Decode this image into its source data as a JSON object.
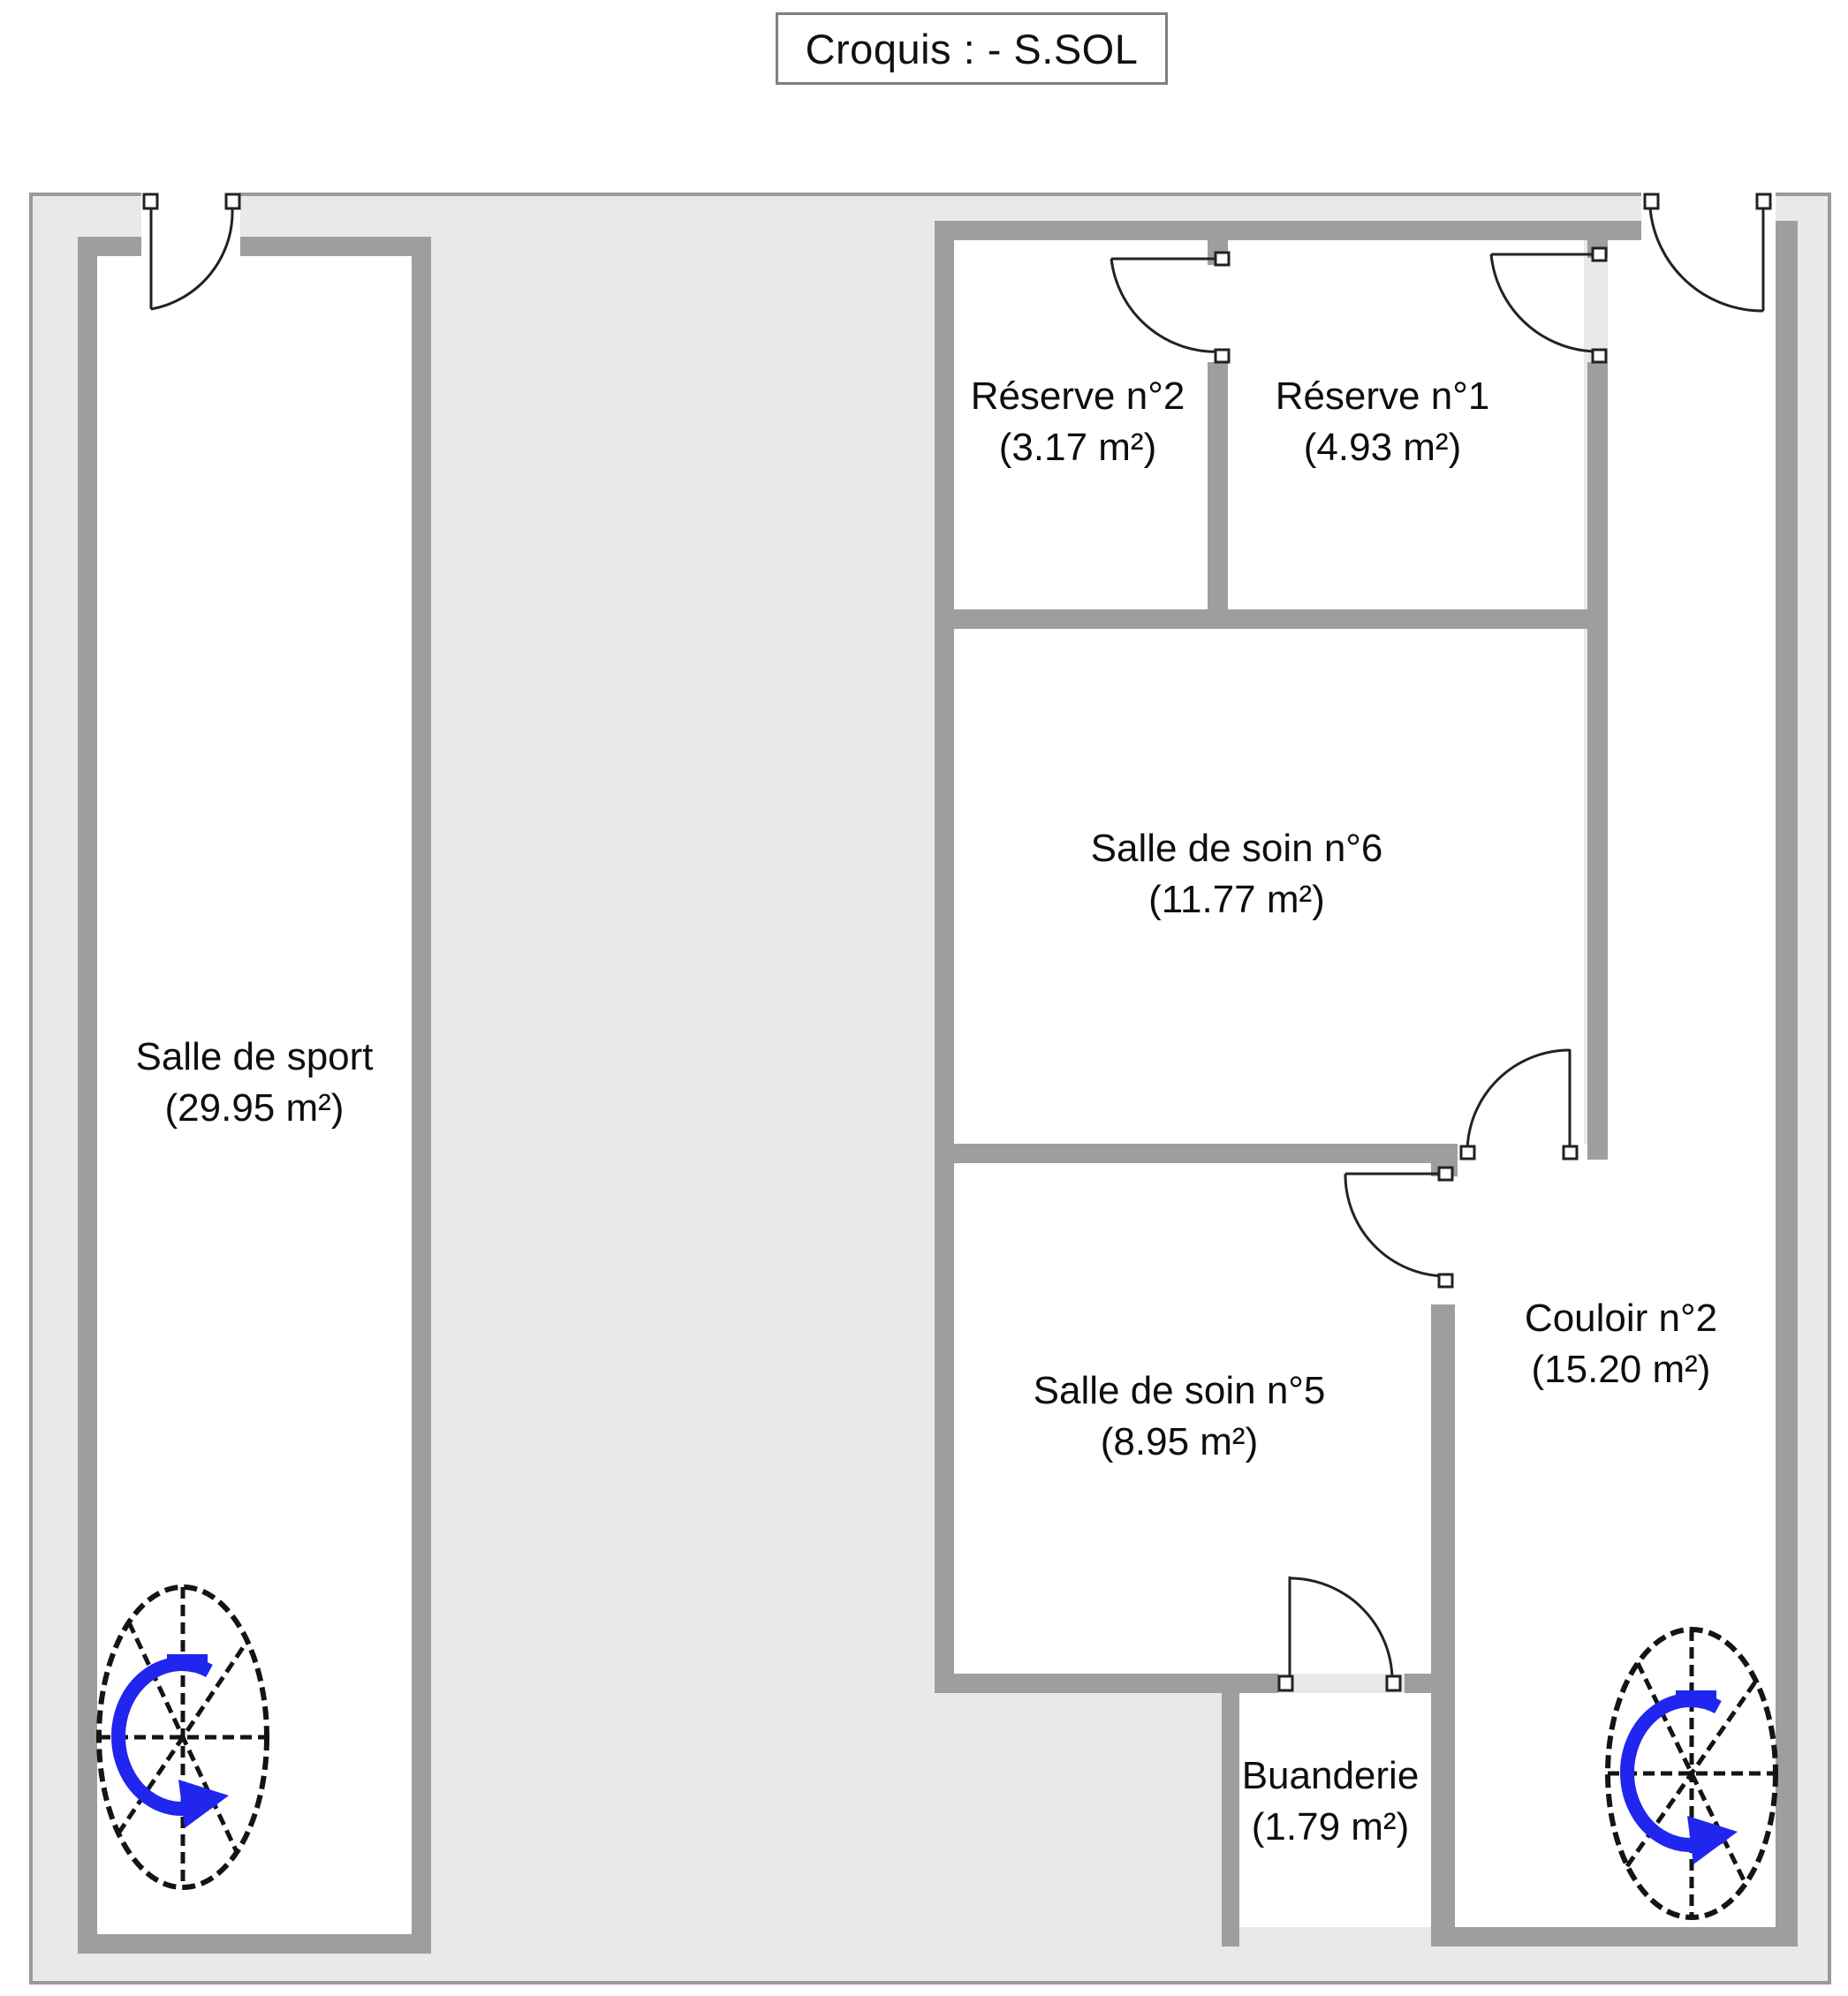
{
  "title": "Croquis :  - S.SOL",
  "floor_plan": {
    "level": "S.SOL",
    "rooms": {
      "sport": {
        "name": "Salle de sport",
        "area": "(29.95 m²)"
      },
      "reserve2": {
        "name": "Réserve n°2",
        "area": "(3.17 m²)"
      },
      "reserve1": {
        "name": "Réserve n°1",
        "area": "(4.93 m²)"
      },
      "soin6": {
        "name": "Salle de soin n°6",
        "area": "(11.77 m²)"
      },
      "soin5": {
        "name": "Salle de soin n°5",
        "area": "(8.95 m²)"
      },
      "couloir2": {
        "name": "Couloir n°2",
        "area": "(15.20 m²)"
      },
      "buanderie": {
        "name": "Buanderie",
        "area": "(1.79 m²)"
      }
    },
    "icons": {
      "staircase_left": "spiral-staircase-icon",
      "staircase_right": "spiral-staircase-icon",
      "doors": "door-swing-icon"
    },
    "colors": {
      "wall": "#9e9e9e",
      "outdoor_fill": "#e9e9e9",
      "room_fill": "#ffffff",
      "door_line": "#222222",
      "stair_arrow_blue": "#2026ee"
    }
  }
}
